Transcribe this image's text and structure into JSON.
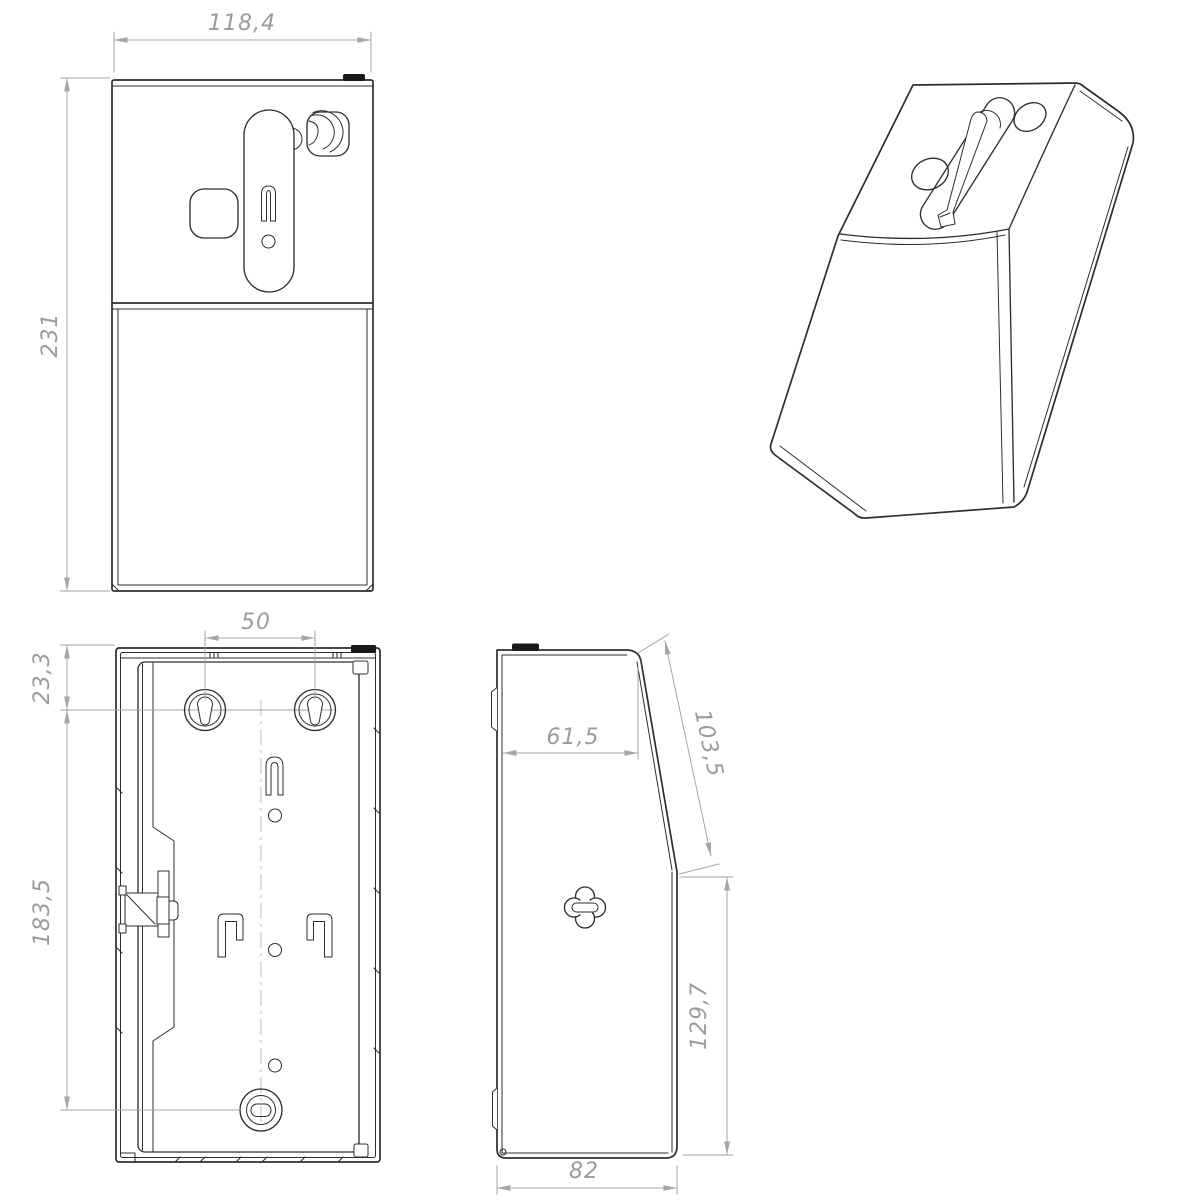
{
  "views": {
    "front": {
      "dims": {
        "width": "118,4",
        "height": "231"
      }
    },
    "rear": {
      "dims": {
        "mount_hole_spacing": "50",
        "top_to_mount_holes": "23,3",
        "mount_holes_to_lock": "183,5"
      }
    },
    "side": {
      "dims": {
        "top_depth": "61,5",
        "slant_length": "103,5",
        "front_face_height": "129,7",
        "depth": "82"
      }
    }
  },
  "theme": {
    "background": "#ffffff",
    "part_line": "#2e2e2e",
    "dim_line": "#a6a6a6",
    "dim_text": "#9b9b9b",
    "tab_fill": "#1a1a1a"
  }
}
